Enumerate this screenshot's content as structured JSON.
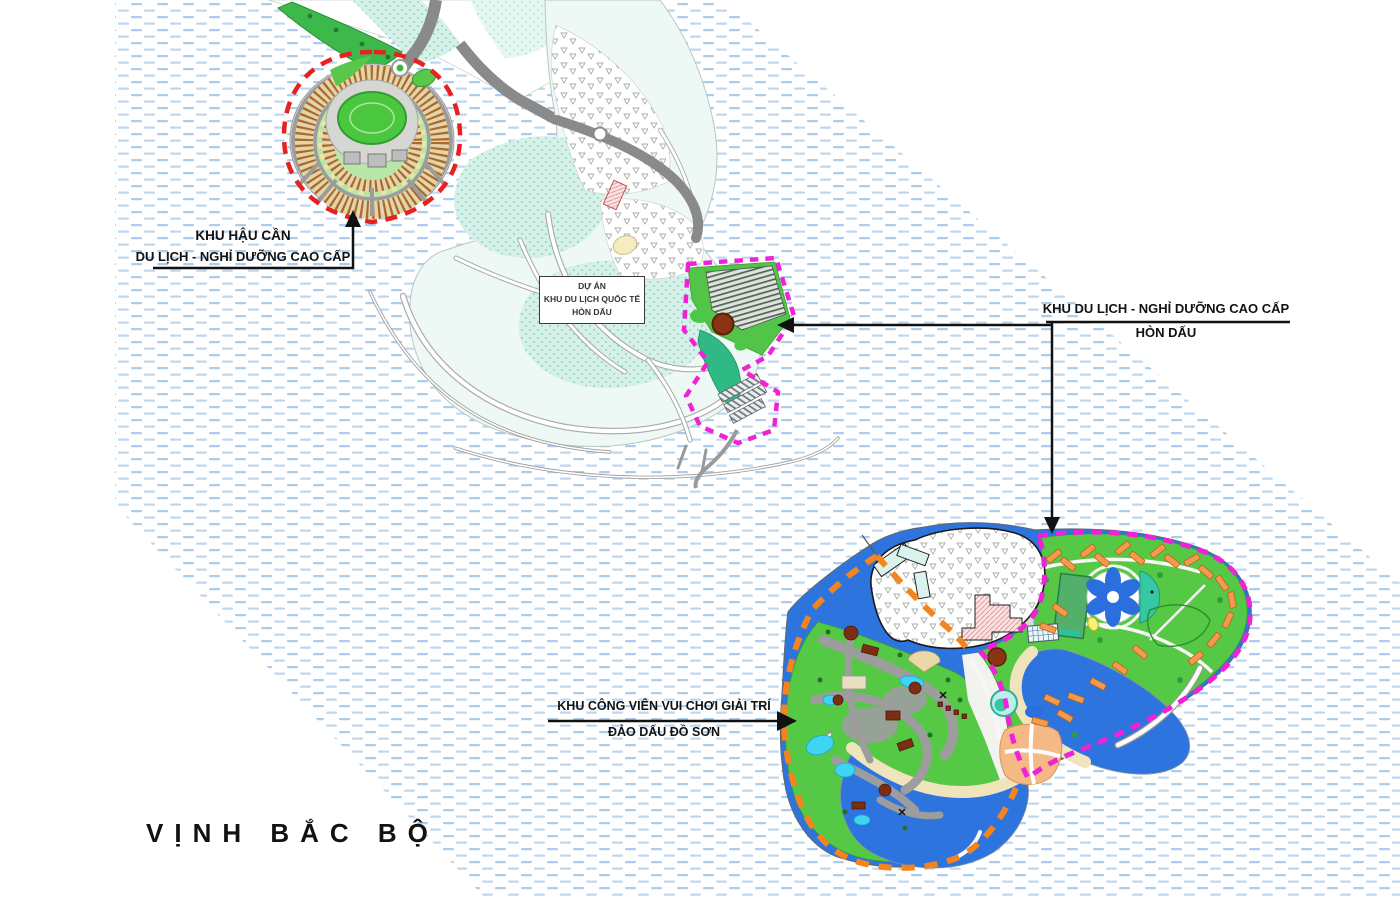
{
  "map": {
    "sea_label": "VỊNH BẮC BỘ",
    "annotations": {
      "logistics": {
        "line1": "KHU HẬU CẦN",
        "line2": "DU LỊCH - NGHỈ DƯỠNG CAO CẤP"
      },
      "project_box": {
        "line1": "DỰ ÁN",
        "line2": "KHU DU LỊCH QUỐC TẾ",
        "line3": "HÒN DẤU"
      },
      "resort": {
        "line1": "KHU DU LỊCH - NGHỈ DƯỠNG CAO CẤP",
        "line2": "HÒN DẤU"
      },
      "amusement_park": {
        "line1": "KHU CÔNG VIÊN VUI CHƠI GIẢI TRÍ",
        "line2": "ĐẢO DẤU ĐỒ SƠN"
      }
    },
    "zones": [
      {
        "name": "KHU HẬU CẦN DU LỊCH - NGHỈ DƯỠNG CAO CẤP",
        "boundary_style": "red-dashed"
      },
      {
        "name": "KHU DU LỊCH - NGHỈ DƯỠNG CAO CẤP HÒN DẤU",
        "boundary_style": "magenta-dashed"
      },
      {
        "name": "KHU CÔNG VIÊN VUI CHƠI GIẢI TRÍ ĐẢO DẤU ĐỒ SƠN",
        "boundary_style": "orange-dashed"
      }
    ],
    "colors": {
      "water_dash": "#a9cdee",
      "water_dash_alt": "#bdd7f0",
      "lagoon_blue": "#2e74df",
      "park_green": "#55c945",
      "beach_sand": "#f0e4bc",
      "villa_orange": "#f29a4e",
      "red_boundary": "#e8201f",
      "magenta_boundary": "#f021d6",
      "orange_boundary": "#f5841e"
    }
  }
}
